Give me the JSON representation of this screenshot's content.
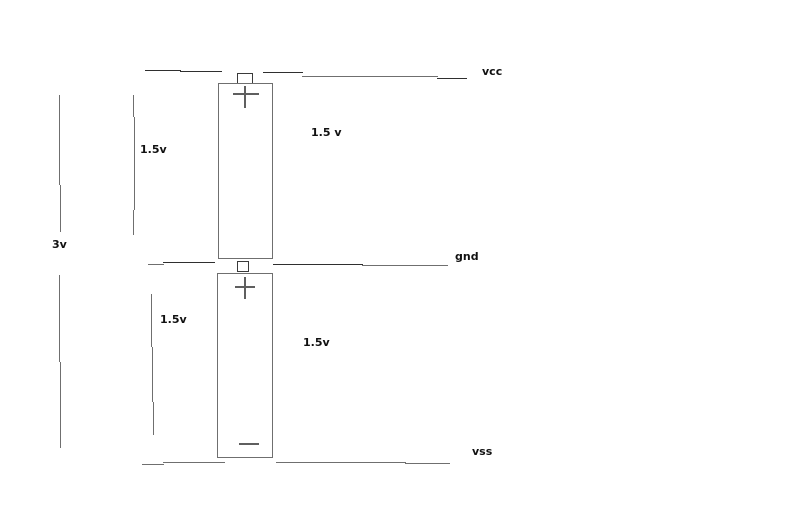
{
  "colors": {
    "background": "#ffffff",
    "wire_gray": "#6f6f6f",
    "wire_dark": "#2f2f2f",
    "text": "#111111"
  },
  "diagram": {
    "type": "battery-series-circuit-sketch",
    "rails": [
      {
        "id": "vcc",
        "label": "vcc"
      },
      {
        "id": "gnd",
        "label": "gnd"
      },
      {
        "id": "vss",
        "label": "vss"
      }
    ],
    "batteries": [
      {
        "name": "top-battery",
        "positive_terminal": "+",
        "left_voltage_label": "1.5v",
        "right_voltage_label": "1.5 v"
      },
      {
        "name": "bottom-battery",
        "positive_terminal": "+",
        "negative_terminal": "−",
        "left_voltage_label": "1.5v",
        "right_voltage_label": "1.5v"
      }
    ],
    "total_voltage_label": "3v"
  }
}
